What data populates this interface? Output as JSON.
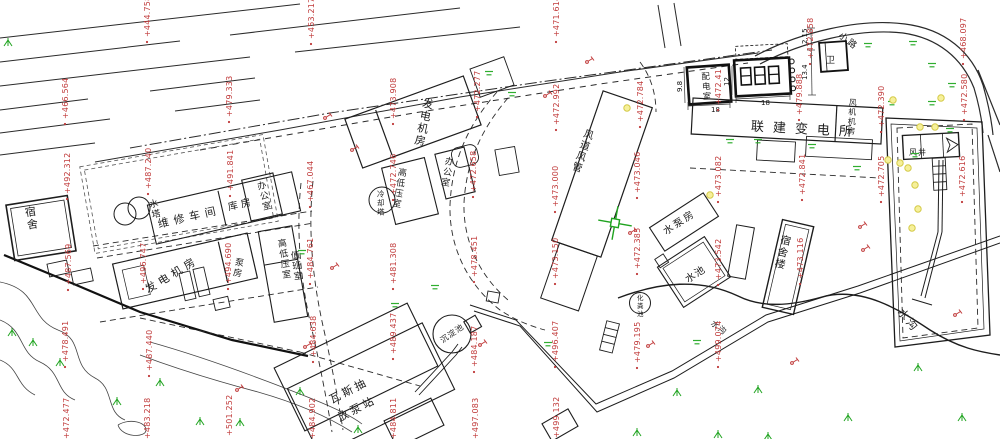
{
  "drawing": {
    "kind": "cad-site-plan",
    "background": "#ffffff"
  },
  "colors": {
    "line": "#2a2a2a",
    "label": "#1c1c1c",
    "elevation": "#c03a3a",
    "pole": "#c03a3a",
    "tree": "#1fa31f",
    "grass": "#2fae2f",
    "light_fill": "#f6f09a",
    "light_stroke": "#d4ca48",
    "cross": "#1fa31f"
  },
  "building_labels": [
    {
      "text": "宿舍",
      "x": 24,
      "y": 206,
      "size": 11,
      "rot": -9,
      "dir": "v"
    },
    {
      "text": "水塔",
      "x": 148,
      "y": 199,
      "size": 9,
      "rot": -13,
      "dir": "v"
    },
    {
      "text": "维修车间",
      "x": 158,
      "y": 224,
      "size": 11,
      "rot": -13,
      "dir": "h",
      "ls": 5
    },
    {
      "text": "库房",
      "x": 228,
      "y": 207,
      "size": 10,
      "rot": -13,
      "dir": "h",
      "ls": 3
    },
    {
      "text": "办公室",
      "x": 256,
      "y": 181,
      "size": 9,
      "rot": -14,
      "dir": "v"
    },
    {
      "text": "发电机房",
      "x": 146,
      "y": 290,
      "size": 11,
      "rot": -31,
      "dir": "h",
      "ls": 4
    },
    {
      "text": "泵房",
      "x": 236,
      "y": 256,
      "size": 9,
      "rot": 10,
      "dir": "v"
    },
    {
      "text": "高低压室",
      "x": 277,
      "y": 238,
      "size": 9,
      "rot": -8,
      "dir": "v"
    },
    {
      "text": "值班室",
      "x": 290,
      "y": 250,
      "size": 9,
      "rot": -8,
      "dir": "v"
    },
    {
      "text": "发电机房",
      "x": 424,
      "y": 96,
      "size": 11,
      "rot": 12,
      "dir": "v"
    },
    {
      "text": "高低压室",
      "x": 399,
      "y": 166,
      "size": 9,
      "rot": 10,
      "dir": "v"
    },
    {
      "text": "办公室",
      "x": 446,
      "y": 155,
      "size": 9,
      "rot": 10,
      "dir": "v"
    },
    {
      "text": "冷却塔",
      "x": 377,
      "y": 189,
      "size": 7.5,
      "rot": 0,
      "dir": "v"
    },
    {
      "text": "风道风管",
      "x": 586,
      "y": 127,
      "size": 10,
      "rot": 19,
      "dir": "v"
    },
    {
      "text": "配电室",
      "x": 701,
      "y": 71,
      "size": 8.5,
      "rot": -4,
      "dir": "v"
    },
    {
      "text": "联建变电所",
      "x": 751,
      "y": 126,
      "size": 13,
      "rot": 3,
      "dir": "h",
      "ls": 9
    },
    {
      "text": "风机机房",
      "x": 849,
      "y": 97,
      "size": 8,
      "rot": 3,
      "dir": "v"
    },
    {
      "text": "卫",
      "x": 826,
      "y": 60,
      "size": 9,
      "rot": 0,
      "dir": "h"
    },
    {
      "text": "水泵房",
      "x": 664,
      "y": 232,
      "size": 10,
      "rot": -33,
      "dir": "h",
      "ls": 2
    },
    {
      "text": "水池",
      "x": 686,
      "y": 280,
      "size": 10,
      "rot": -33,
      "dir": "h",
      "ls": 1
    },
    {
      "text": "宿舍楼",
      "x": 782,
      "y": 233,
      "size": 10.5,
      "rot": 13,
      "dir": "v"
    },
    {
      "text": "瓦斯抽",
      "x": 330,
      "y": 400,
      "size": 11,
      "rot": -27,
      "dir": "h",
      "ls": 3
    },
    {
      "text": "放泵站",
      "x": 338,
      "y": 418,
      "size": 11,
      "rot": -27,
      "dir": "h",
      "ls": 3
    },
    {
      "text": "沉淀池",
      "x": 441,
      "y": 341,
      "size": 8,
      "rot": -35,
      "dir": "h",
      "ls": 1
    },
    {
      "text": "化粪池",
      "x": 637,
      "y": 293,
      "size": 6.5,
      "rot": 0,
      "dir": "v"
    },
    {
      "text": "风井",
      "x": 909,
      "y": 152,
      "size": 8,
      "rot": 0,
      "dir": "h",
      "ls": 1
    },
    {
      "text": "小路",
      "x": 840,
      "y": 34,
      "size": 9,
      "rot": 38,
      "dir": "h",
      "ls": 2
    },
    {
      "text": "水沟",
      "x": 712,
      "y": 322,
      "size": 8,
      "rot": 38,
      "dir": "h",
      "ls": 1
    },
    {
      "text": "水沟",
      "x": 900,
      "y": 310,
      "size": 11,
      "rot": 50,
      "dir": "h",
      "ls": 2
    }
  ],
  "dimensions": [
    {
      "text": "18",
      "x": 711,
      "y": 112,
      "rot": 0
    },
    {
      "text": "18",
      "x": 761,
      "y": 105,
      "rot": 0
    },
    {
      "text": "12",
      "x": 729,
      "y": 86,
      "rot": -90
    },
    {
      "text": "9.8",
      "x": 682,
      "y": 92,
      "rot": -90
    },
    {
      "text": "2.15",
      "x": 807,
      "y": 44,
      "rot": -90
    },
    {
      "text": "13.4",
      "x": 807,
      "y": 80,
      "rot": -90
    }
  ],
  "elevation_points": [
    {
      "x": 147,
      "y": 42,
      "value": "+444.758"
    },
    {
      "x": 311,
      "y": 44,
      "value": "+453.217"
    },
    {
      "x": 556,
      "y": 42,
      "value": "+471.614"
    },
    {
      "x": 810,
      "y": 64,
      "value": "+472.858"
    },
    {
      "x": 963,
      "y": 64,
      "value": "+468.097"
    },
    {
      "x": 65,
      "y": 124,
      "value": "+466.564"
    },
    {
      "x": 229,
      "y": 122,
      "value": "+479.333"
    },
    {
      "x": 393,
      "y": 124,
      "value": "+473.908"
    },
    {
      "x": 477,
      "y": 117,
      "value": "+472.277"
    },
    {
      "x": 556,
      "y": 130,
      "value": "+472.992"
    },
    {
      "x": 640,
      "y": 127,
      "value": "+472.784"
    },
    {
      "x": 718,
      "y": 110,
      "value": "+472.41"
    },
    {
      "x": 799,
      "y": 120,
      "value": "+479.888"
    },
    {
      "x": 881,
      "y": 132,
      "value": "+472.390"
    },
    {
      "x": 964,
      "y": 120,
      "value": "+472.580"
    },
    {
      "x": 67,
      "y": 199,
      "value": "+492.312"
    },
    {
      "x": 148,
      "y": 194,
      "value": "+487.240"
    },
    {
      "x": 230,
      "y": 196,
      "value": "+491.841"
    },
    {
      "x": 310,
      "y": 207,
      "value": "+467.044"
    },
    {
      "x": 393,
      "y": 200,
      "value": "+472.746"
    },
    {
      "x": 473,
      "y": 197,
      "value": "+472.658"
    },
    {
      "x": 555,
      "y": 212,
      "value": "+473.000"
    },
    {
      "x": 637,
      "y": 198,
      "value": "+473.046"
    },
    {
      "x": 718,
      "y": 202,
      "value": "+473.082"
    },
    {
      "x": 802,
      "y": 200,
      "value": "+472.841"
    },
    {
      "x": 881,
      "y": 202,
      "value": "+472.705"
    },
    {
      "x": 962,
      "y": 202,
      "value": "+472.616"
    },
    {
      "x": 68,
      "y": 290,
      "value": "+487.569"
    },
    {
      "x": 143,
      "y": 289,
      "value": "+496.747"
    },
    {
      "x": 228,
      "y": 289,
      "value": "+494.690"
    },
    {
      "x": 310,
      "y": 284,
      "value": "+484.761"
    },
    {
      "x": 393,
      "y": 289,
      "value": "+481.308"
    },
    {
      "x": 474,
      "y": 282,
      "value": "+478.451"
    },
    {
      "x": 555,
      "y": 284,
      "value": "+473.150"
    },
    {
      "x": 637,
      "y": 274,
      "value": "+472.385"
    },
    {
      "x": 718,
      "y": 285,
      "value": "+473.542"
    },
    {
      "x": 800,
      "y": 284,
      "value": "+473.116"
    },
    {
      "x": 65,
      "y": 367,
      "value": "+478.491"
    },
    {
      "x": 149,
      "y": 376,
      "value": "+487.440"
    },
    {
      "x": 313,
      "y": 362,
      "value": "+484.638"
    },
    {
      "x": 393,
      "y": 359,
      "value": "+489.437"
    },
    {
      "x": 474,
      "y": 372,
      "value": "+484.187"
    },
    {
      "x": 555,
      "y": 367,
      "value": "+496.407"
    },
    {
      "x": 637,
      "y": 368,
      "value": "+479.195"
    },
    {
      "x": 718,
      "y": 367,
      "value": "+499.074"
    },
    {
      "x": 66,
      "y": 444,
      "value": "+472.477"
    },
    {
      "x": 147,
      "y": 444,
      "value": "+483.218"
    },
    {
      "x": 229,
      "y": 441,
      "value": "+501.252"
    },
    {
      "x": 312,
      "y": 444,
      "value": "+484.902"
    },
    {
      "x": 393,
      "y": 444,
      "value": "+484.811"
    },
    {
      "x": 475,
      "y": 444,
      "value": "+497.083"
    },
    {
      "x": 556,
      "y": 443,
      "value": "+499.132"
    }
  ],
  "symbols": {
    "trees": [
      [
        8,
        43
      ],
      [
        12,
        333
      ],
      [
        33,
        343
      ],
      [
        60,
        363
      ],
      [
        117,
        402
      ],
      [
        160,
        383
      ],
      [
        200,
        422
      ],
      [
        240,
        423
      ],
      [
        300,
        392
      ],
      [
        358,
        430
      ],
      [
        637,
        433
      ],
      [
        677,
        393
      ],
      [
        718,
        435
      ],
      [
        758,
        390
      ],
      [
        768,
        437
      ],
      [
        848,
        418
      ],
      [
        918,
        368
      ],
      [
        962,
        418
      ]
    ],
    "grass": [
      [
        489,
        73
      ],
      [
        512,
        94
      ],
      [
        868,
        45
      ],
      [
        913,
        43
      ],
      [
        932,
        65
      ],
      [
        952,
        85
      ],
      [
        932,
        103
      ],
      [
        892,
        103
      ],
      [
        950,
        130
      ],
      [
        915,
        155
      ],
      [
        730,
        141
      ],
      [
        758,
        141
      ],
      [
        812,
        146
      ],
      [
        857,
        168
      ],
      [
        302,
        252
      ],
      [
        395,
        305
      ],
      [
        435,
        287
      ],
      [
        697,
        342
      ],
      [
        548,
        344
      ]
    ],
    "lights": [
      [
        627,
        108
      ],
      [
        710,
        195
      ],
      [
        893,
        100
      ],
      [
        941,
        98
      ],
      [
        920,
        127
      ],
      [
        935,
        127
      ],
      [
        888,
        160
      ],
      [
        900,
        163
      ],
      [
        908,
        168
      ],
      [
        915,
        185
      ],
      [
        918,
        209
      ],
      [
        912,
        228
      ]
    ],
    "poles": [
      [
        325,
        118
      ],
      [
        352,
        150
      ],
      [
        332,
        268
      ],
      [
        305,
        347
      ],
      [
        545,
        96
      ],
      [
        587,
        62
      ],
      [
        630,
        233
      ],
      [
        480,
        345
      ],
      [
        648,
        346
      ],
      [
        792,
        363
      ],
      [
        860,
        227
      ],
      [
        863,
        250
      ],
      [
        955,
        315
      ],
      [
        237,
        390
      ]
    ]
  }
}
